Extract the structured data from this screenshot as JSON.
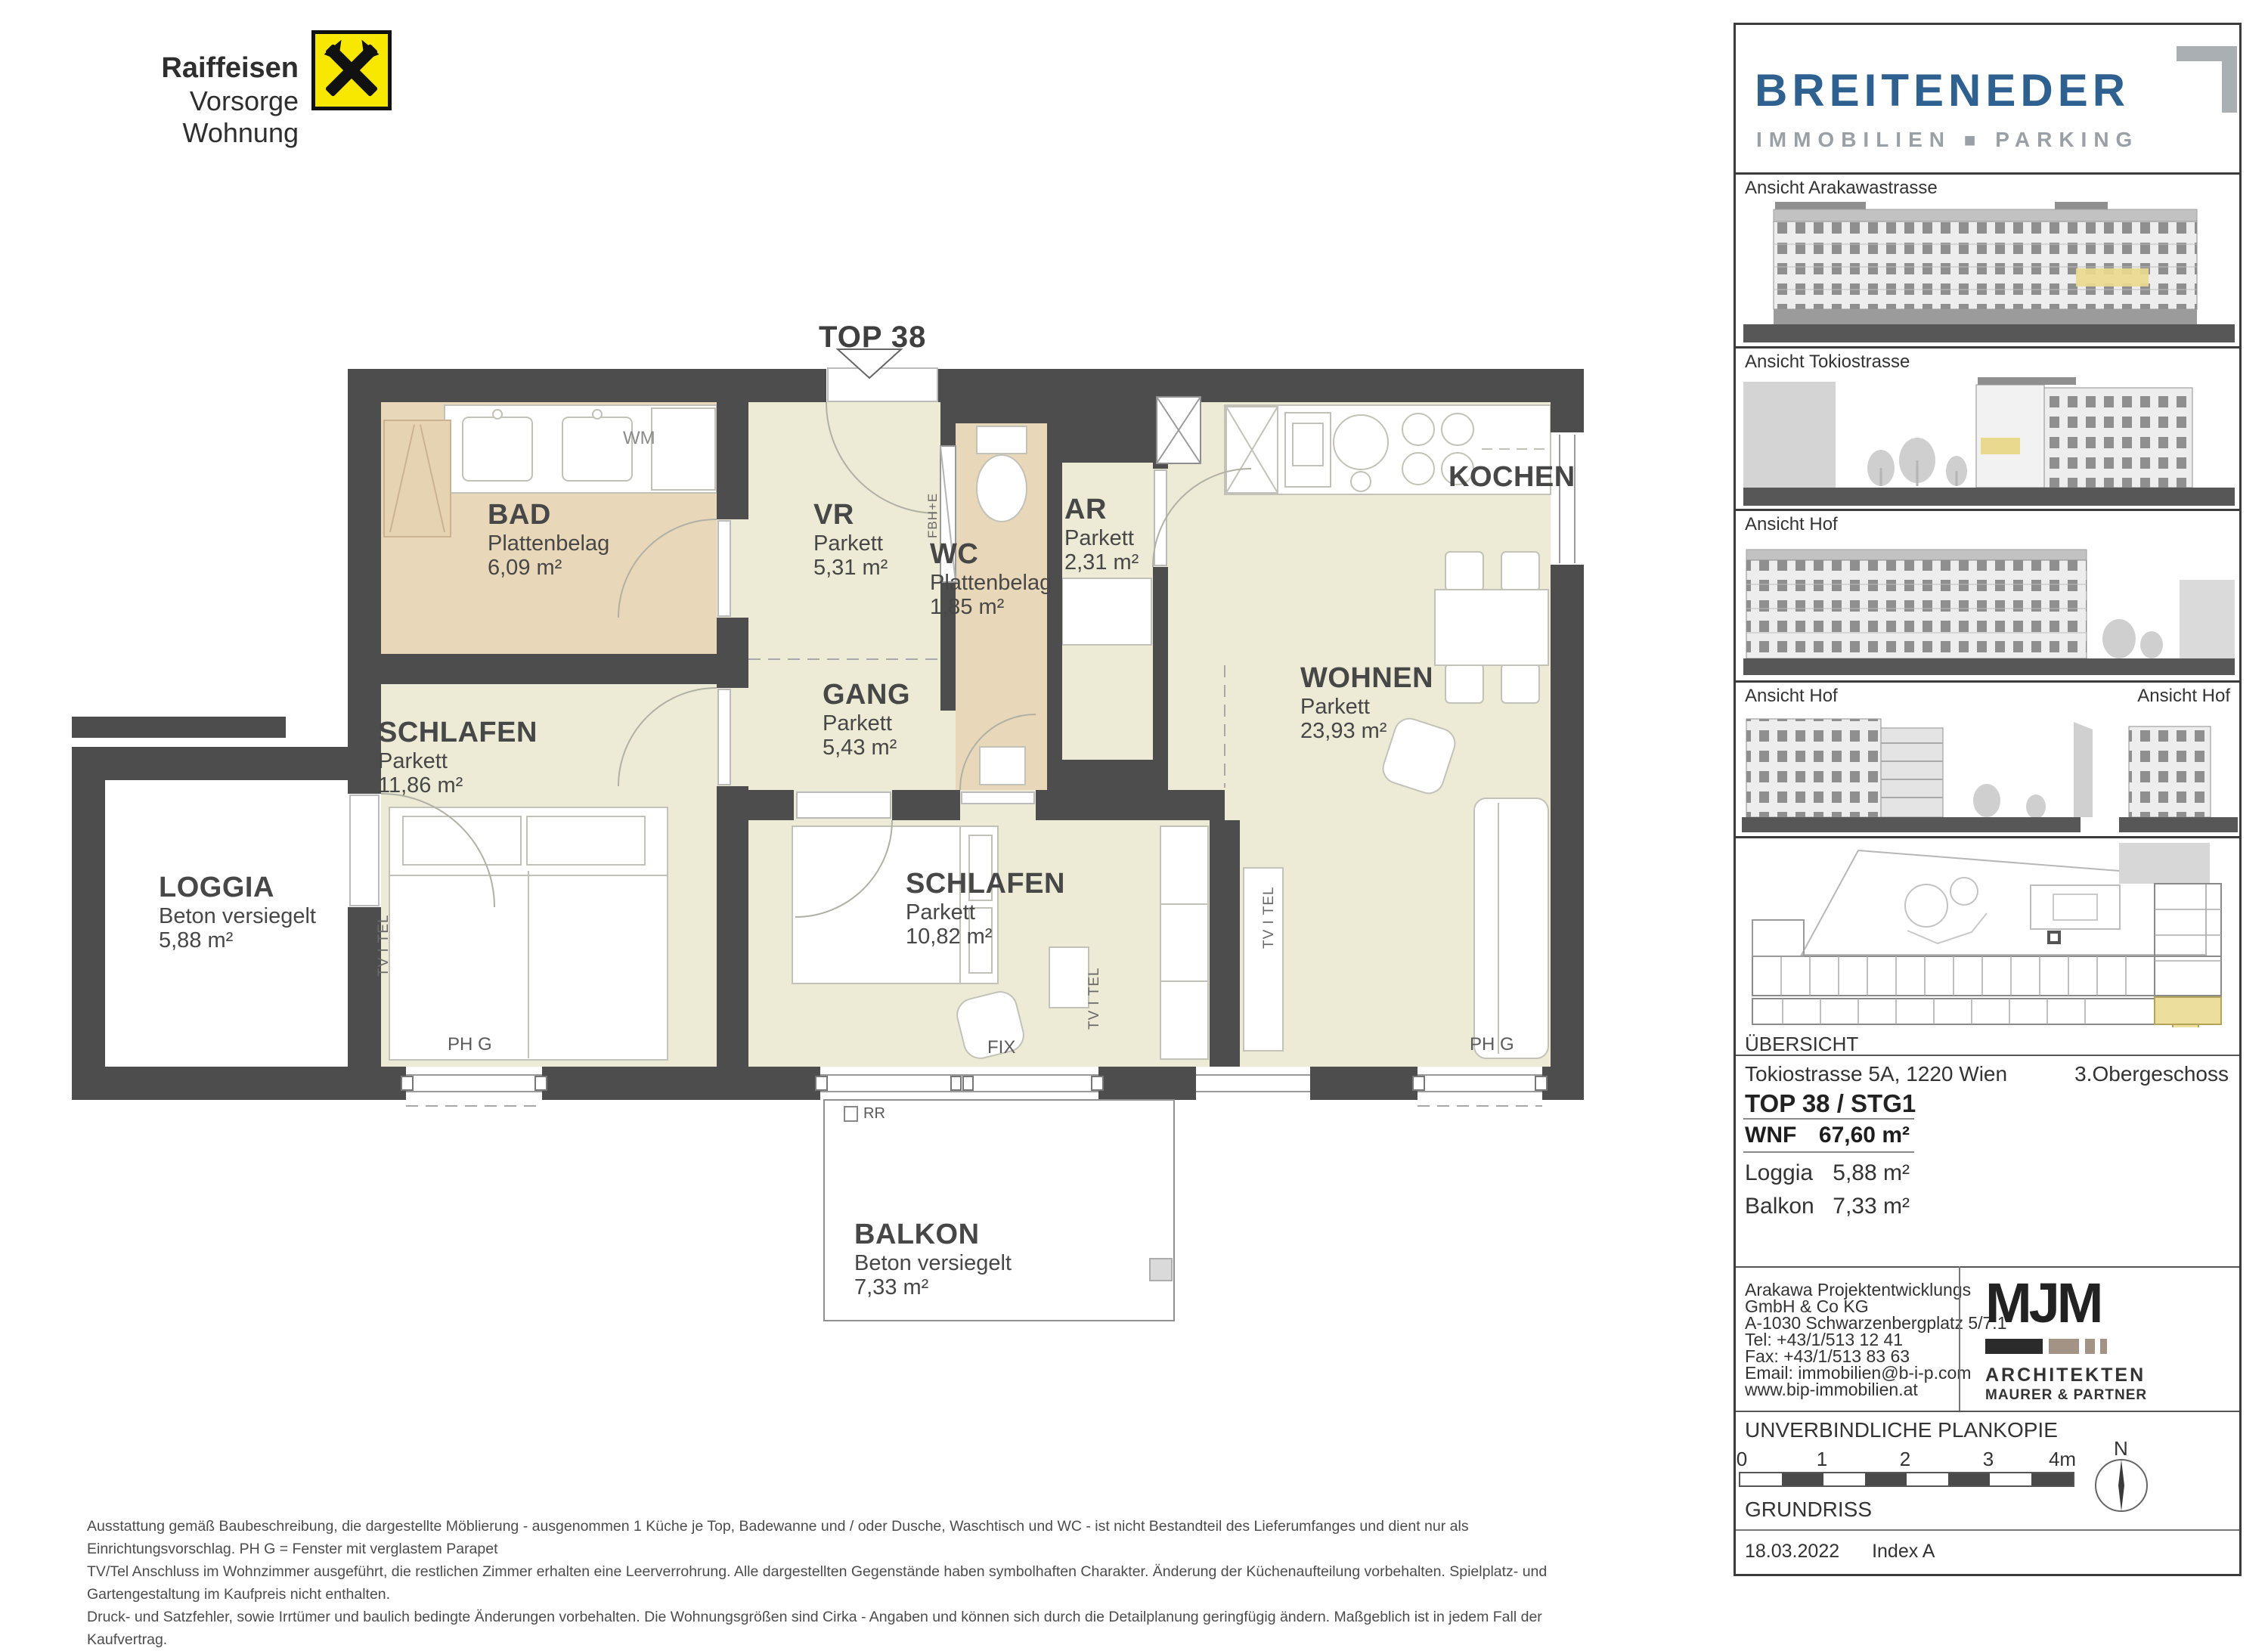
{
  "branding": {
    "raiffeisen_line1": "Raiffeisen",
    "raiffeisen_line2": "Vorsorge Wohnung",
    "breiteneder": "BREITENEDER",
    "breiteneder_sub_left": "IMMOBILIEN",
    "breiteneder_sub_sep": "■",
    "breiteneder_sub_right": "PARKING"
  },
  "plan": {
    "unit_callout": "TOP 38",
    "kitchen_label": "KOCHEN",
    "rooms": [
      {
        "name": "BAD",
        "floor": "Plattenbelag",
        "area": "6,09 m²"
      },
      {
        "name": "VR",
        "floor": "Parkett",
        "area": "5,31 m²"
      },
      {
        "name": "WC",
        "floor": "Plattenbelag",
        "area": "1,85 m²"
      },
      {
        "name": "AR",
        "floor": "Parkett",
        "area": "2,31 m²"
      },
      {
        "name": "GANG",
        "floor": "Parkett",
        "area": "5,43 m²"
      },
      {
        "name": "WOHNEN",
        "floor": "Parkett",
        "area": "23,93 m²"
      },
      {
        "name": "SCHLAFEN",
        "floor": "Parkett",
        "area": "11,86 m²"
      },
      {
        "name": "SCHLAFEN",
        "floor": "Parkett",
        "area": "10,82 m²"
      },
      {
        "name": "LOGGIA",
        "floor": "Beton versiegelt",
        "area": "5,88 m²"
      },
      {
        "name": "BALKON",
        "floor": "Beton versiegelt",
        "area": "7,33 m²"
      }
    ],
    "annotations": {
      "wm": "WM",
      "ph_g": "PH G",
      "fix": "FIX",
      "rr": "RR",
      "tv_tel": "TV I TEL",
      "fbh_e": "FBH+E"
    },
    "colors": {
      "wall": "#4d4d4d",
      "parquet": "#edead5",
      "tiles": "#e8d7b9",
      "highlight": "#e9d98e"
    }
  },
  "sidebar": {
    "views": [
      {
        "label": "Ansicht Arakawastrasse"
      },
      {
        "label": "Ansicht Tokiostrasse"
      },
      {
        "label": "Ansicht Hof"
      },
      {
        "label": "Ansicht Hof",
        "label_right": "Ansicht Hof"
      }
    ],
    "overview_label": "ÜBERSICHT",
    "address": "Tokiostrasse 5A, 1220 Wien",
    "floor_label": "3.Obergeschoss",
    "unit_title": "TOP 38 / STG1",
    "metrics": [
      {
        "label": "WNF",
        "value": "67,60 m²"
      },
      {
        "label": "Loggia",
        "value": "5,88 m²"
      },
      {
        "label": "Balkon",
        "value": "7,33 m²"
      }
    ],
    "contact_lines": [
      "Arakawa Projektentwicklungs",
      "GmbH & Co KG",
      "A-1030 Schwarzenbergplatz 5/7.1",
      "Tel: +43/1/513 12 41",
      "Fax: +43/1/513 83 63",
      "Email: immobilien@b-i-p.com",
      "www.bip-immobilien.at"
    ],
    "architect": {
      "logo": "MJM",
      "line1": "ARCHITEKTEN",
      "line2": "MAURER & PARTNER"
    },
    "plan_copy": "UNVERBINDLICHE PLANKOPIE",
    "scale": {
      "ticks": [
        "0",
        "1",
        "2",
        "3",
        "4m"
      ],
      "north": "N"
    },
    "drawing_type": "GRUNDRISS",
    "date": "18.03.2022",
    "index": "Index A"
  },
  "disclaimer": {
    "line1": "Ausstattung gemäß Baubeschreibung, die dargestellte Möblierung - ausgenommen 1 Küche je Top, Badewanne und / oder Dusche, Waschtisch und WC - ist nicht Bestandteil des Lieferumfanges und dient nur als Einrichtungsvorschlag. PH G = Fenster mit verglastem Parapet",
    "line2": "TV/Tel Anschluss im Wohnzimmer ausgeführt, die restlichen Zimmer erhalten eine Leerverrohrung. Alle dargestellten Gegenstände haben symbolhaften Charakter. Änderung der Küchenaufteilung vorbehalten. Spielplatz- und Gartengestaltung im Kaufpreis nicht enthalten.",
    "line3": "Druck- und Satzfehler, sowie Irrtümer und baulich bedingte Änderungen vorbehalten. Die Wohnungsgrößen sind Cirka - Angaben und können sich durch die Detailplanung geringfügig ändern. Maßgeblich ist in jedem Fall der Kaufvertrag."
  }
}
